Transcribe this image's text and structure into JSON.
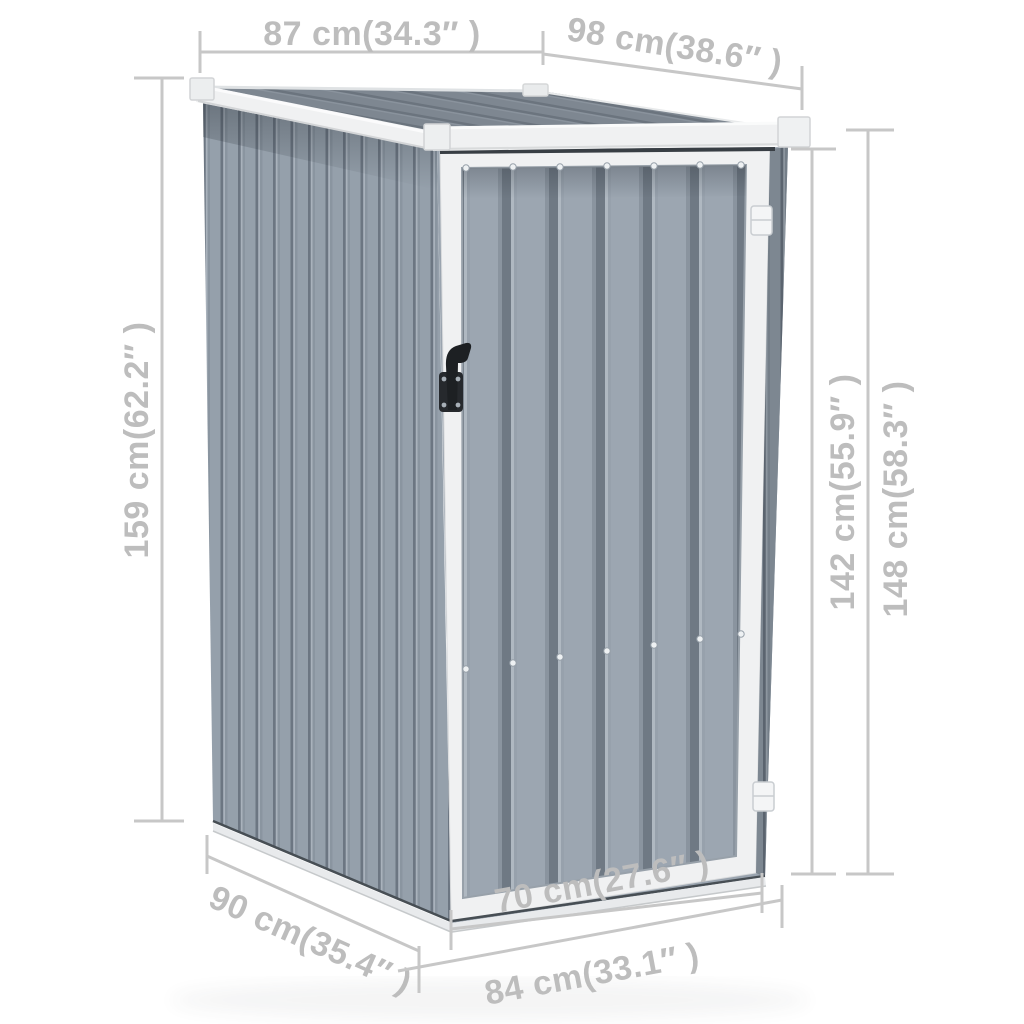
{
  "image": {
    "type": "product-dimension-diagram",
    "subject": "grey galvanised steel garden shed with single door",
    "background": "#ffffff"
  },
  "dimensions": {
    "roof_width": {
      "label": "87 cm(34.3″ )"
    },
    "roof_depth": {
      "label": "98 cm(38.6″ )"
    },
    "front_height": {
      "label": "159 cm(62.2″ )"
    },
    "door_height": {
      "label": "142 cm(55.9″ )"
    },
    "total_height": {
      "label": "148 cm(58.3″ )"
    },
    "base_depth": {
      "label": "90 cm(35.4″ )"
    },
    "door_width": {
      "label": "70 cm(27.6″ )"
    },
    "base_width": {
      "label": "84 cm(33.1″ )"
    }
  },
  "colors": {
    "dimension_text": "#BDBDBD",
    "dimension_line": "#C7C7C7",
    "roof_base": "#7E8791",
    "roof_ridge": "#6B747E",
    "wall_light": "#95A0AB",
    "wall_ridge": "#6C7682",
    "door_light": "#9CA6B1",
    "door_ridge": "#6F7984",
    "trim_white": "#F0F1F2",
    "handle_black": "#1D2023"
  }
}
